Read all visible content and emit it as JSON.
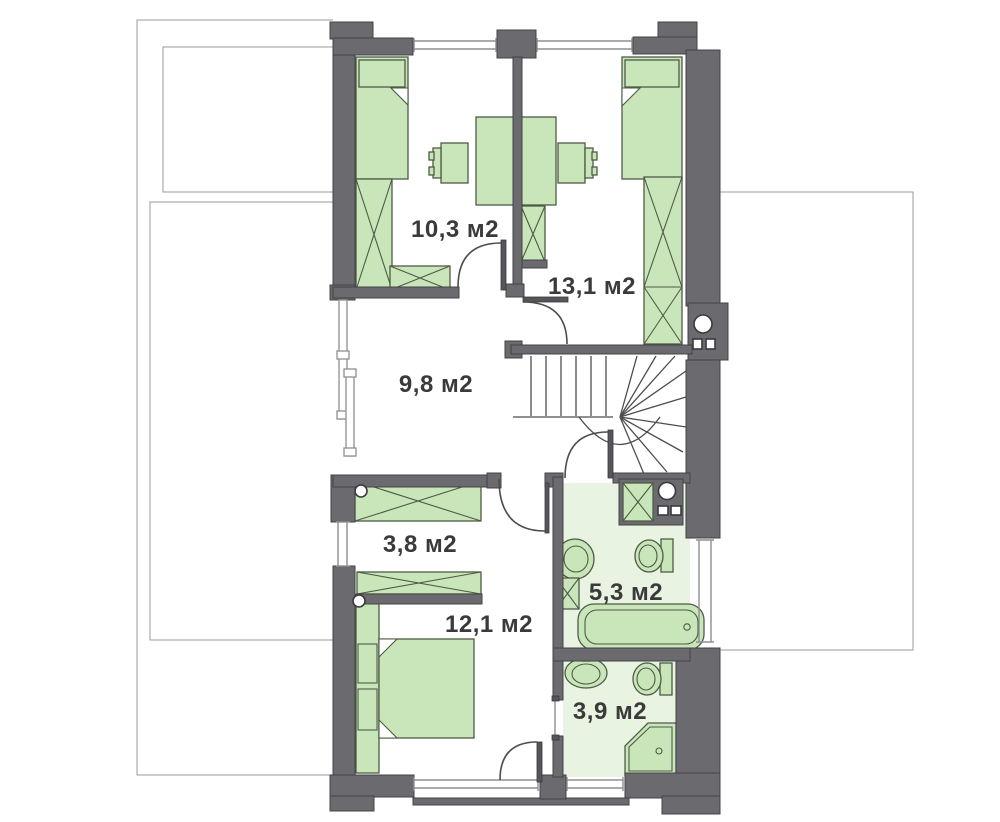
{
  "page": {
    "background": "#ffffff",
    "type": "second-floor plan drawing"
  },
  "colors": {
    "wall": "#6b6b6f",
    "furniture_fill": "#c9e6ba",
    "furniture_stroke": "#4e5b45",
    "bathroom_floor": "#e9f3e2",
    "roof_outline": "#9b9b9b",
    "text": "#3a3a3a"
  },
  "floor_plan": {
    "rooms": [
      {
        "id": "bedroom-top-left",
        "area_label": "10,3 м2"
      },
      {
        "id": "bedroom-top-right",
        "area_label": "13,1 м2"
      },
      {
        "id": "hall",
        "area_label": "9,8 м2"
      },
      {
        "id": "wardrobe-room",
        "area_label": "3,8 м2"
      },
      {
        "id": "bedroom-bottom",
        "area_label": "12,1 м2"
      },
      {
        "id": "bathroom-large",
        "area_label": "5,3 м2"
      },
      {
        "id": "bathroom-small",
        "area_label": "3,9 м2"
      }
    ]
  }
}
